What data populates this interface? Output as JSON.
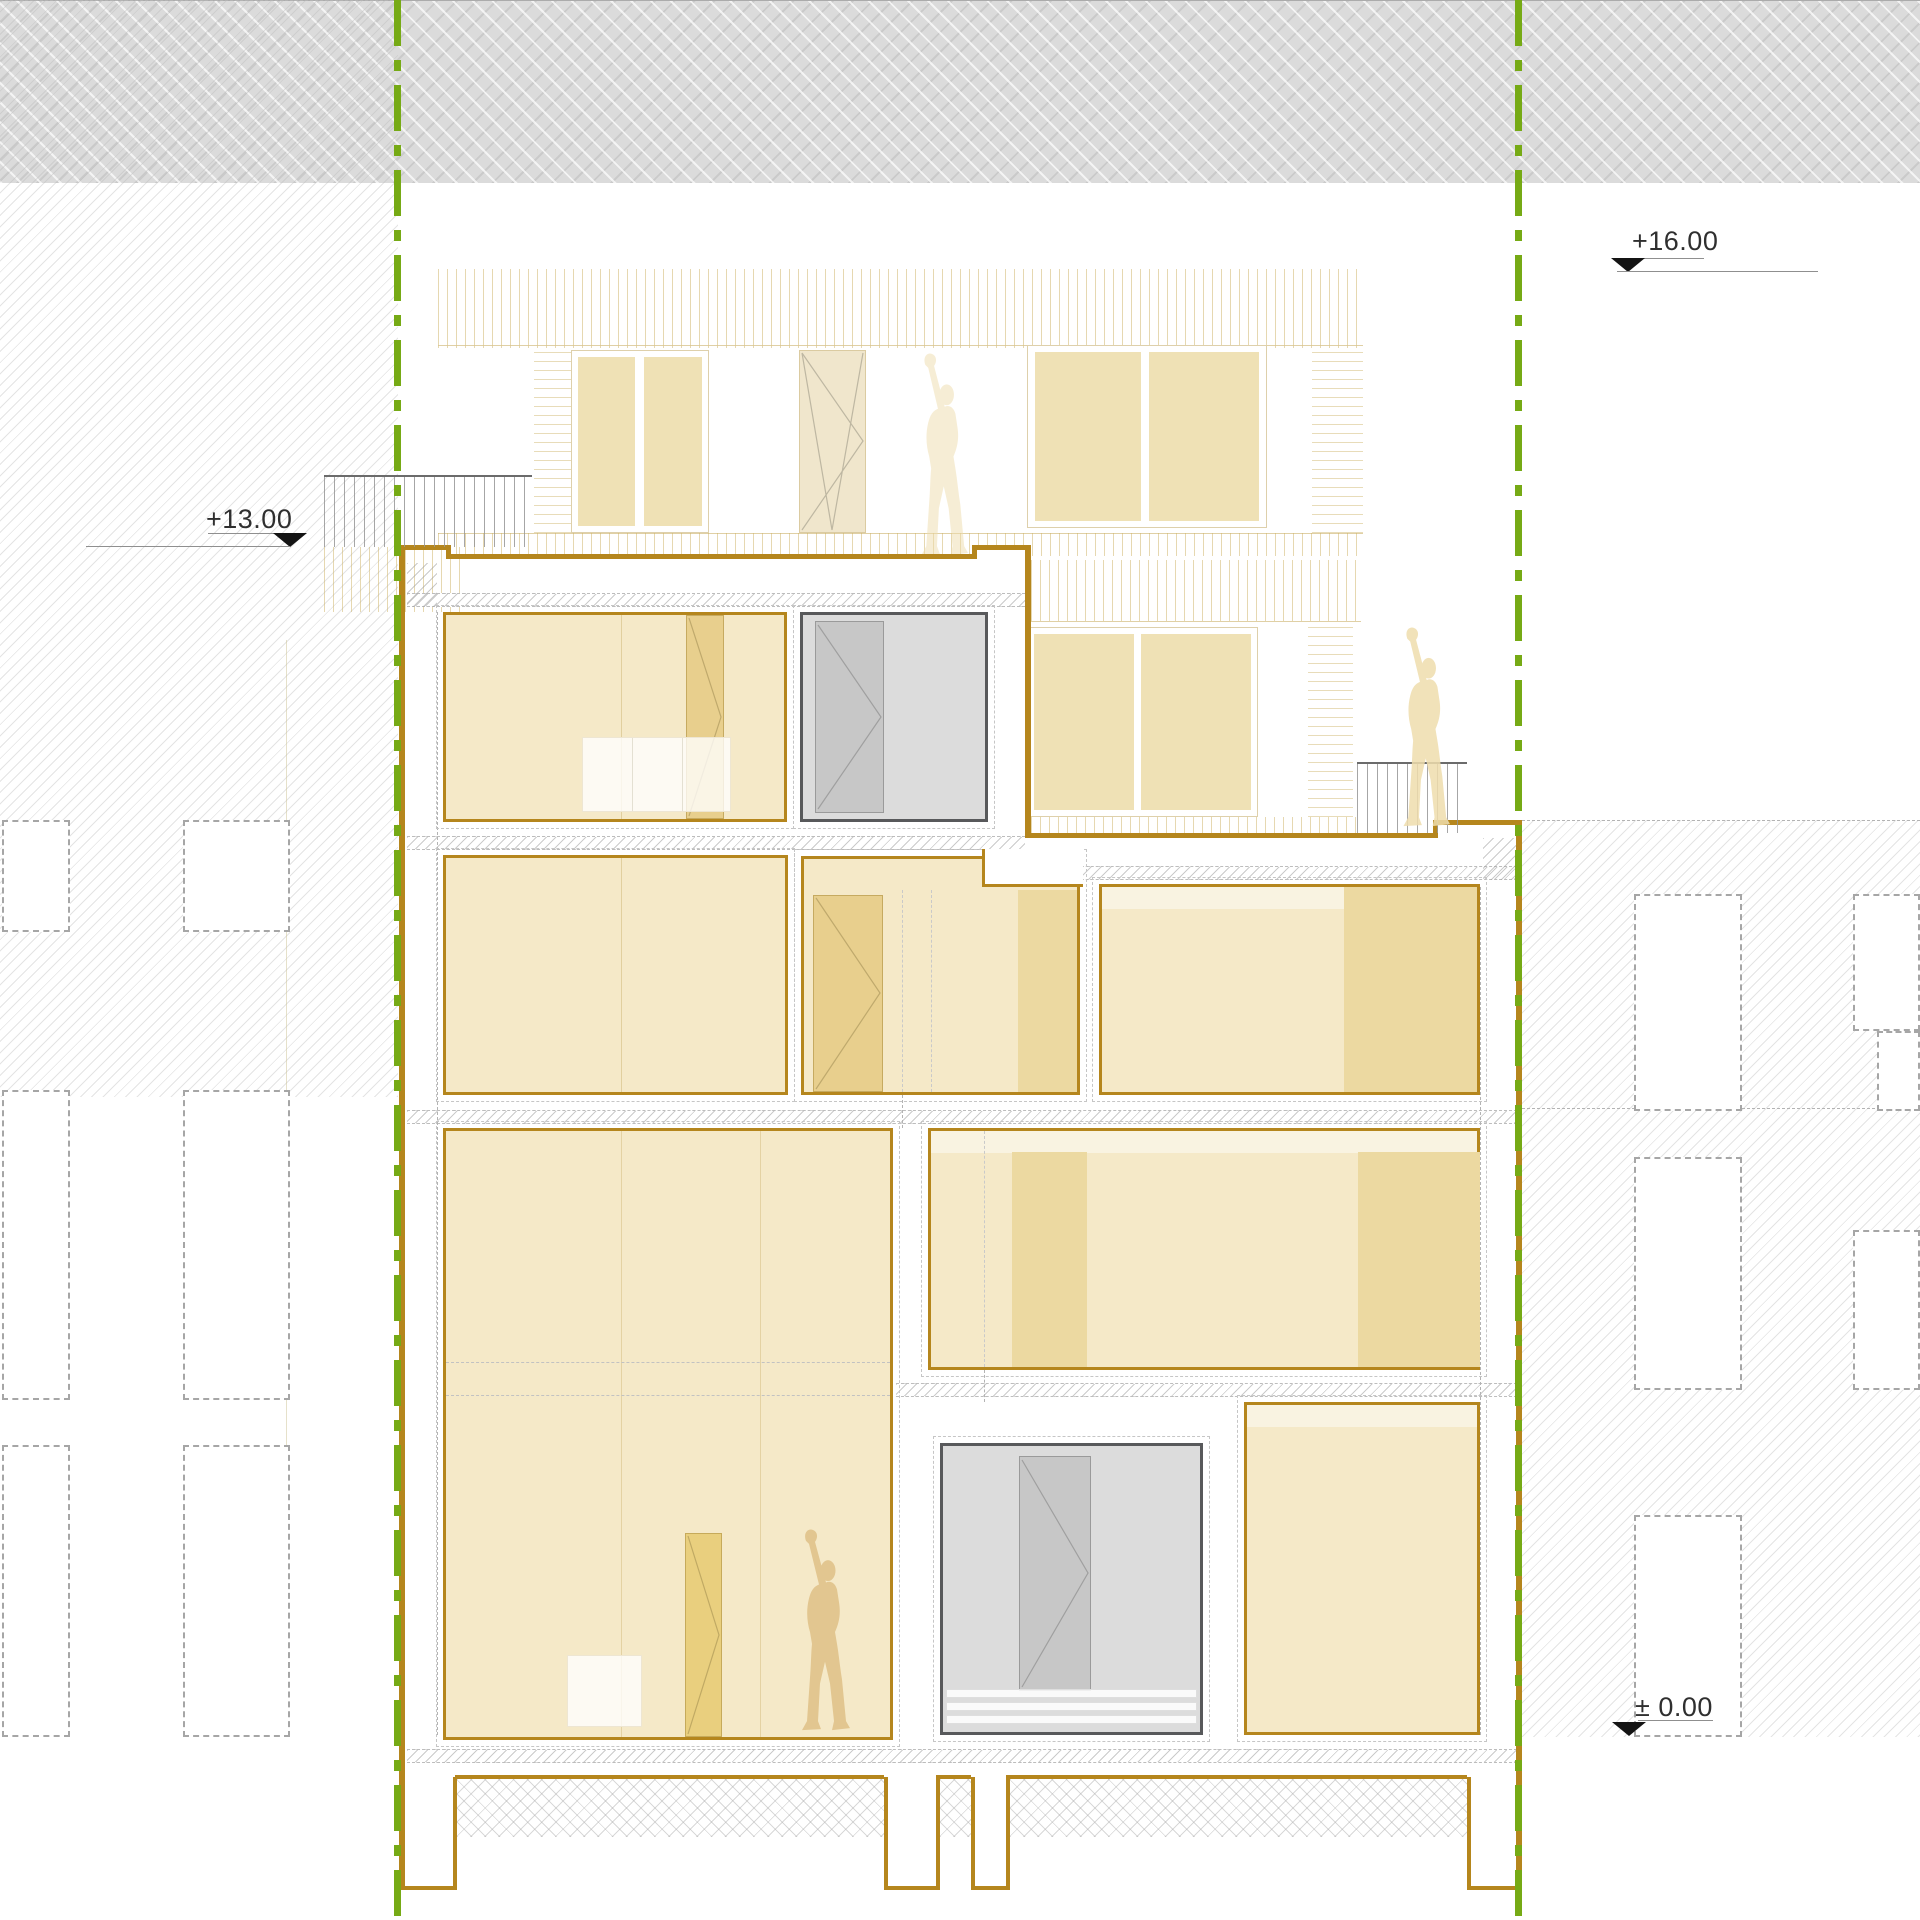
{
  "drawing": {
    "kind": "architectural-building-section",
    "levels": {
      "upper": {
        "label": "+16.00"
      },
      "roof": {
        "label": "+13.00"
      },
      "ground": {
        "label": "± 0.00"
      }
    }
  },
  "icons": {
    "level_marker": "filled-triangle-down",
    "human_figure": "modulor-silhouette",
    "boundary_line": "green-dash-dot-property-line"
  },
  "colors": {
    "section_line": "#b5861d",
    "room_fill": "#f5e9c8",
    "room_fill_dark": "#ecd9a1",
    "door_fill": "#e8cf8d",
    "faded_pane": "#efe1b5",
    "gray_fill": "#dcdcdc",
    "gray_leaf": "#c7c7c7",
    "gray_border": "#58595b",
    "figure": "#efddad",
    "figure_dark": "#e2c690",
    "boundary_green": "#76aa15",
    "soil_gray": "#dbdbdb",
    "text": "#2f2f2f"
  }
}
